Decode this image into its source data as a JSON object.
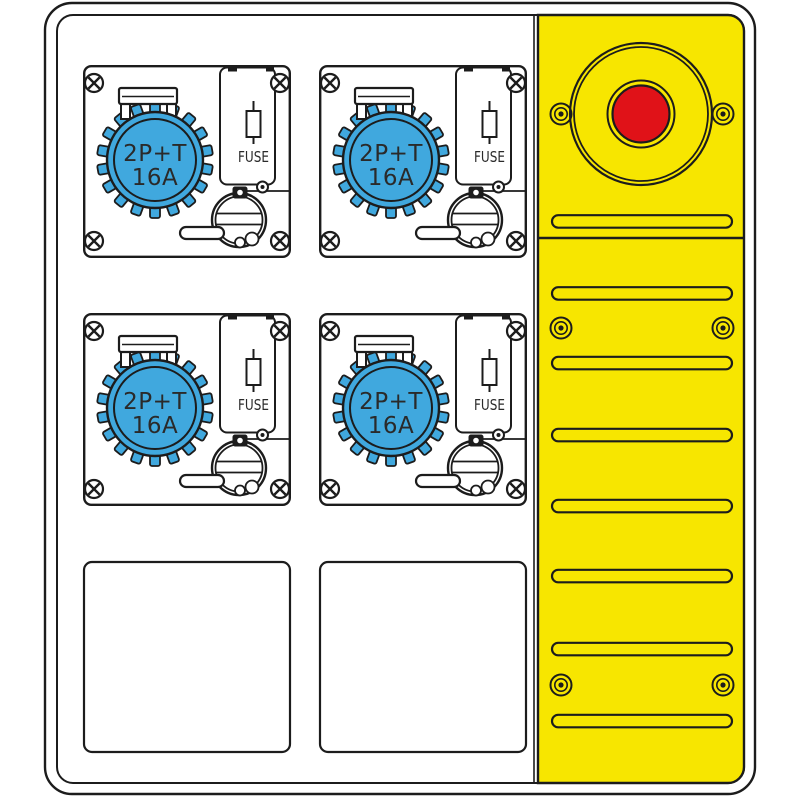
{
  "colors": {
    "socket_blue": "#40A8DE",
    "panel_yellow": "#F7E600",
    "estop_red": "#E01218",
    "outline": "#1C1C1C"
  },
  "modules": [
    {
      "rating_top": "2P+T",
      "rating_bottom": "16A",
      "fuse_label": "FUSE"
    },
    {
      "rating_top": "2P+T",
      "rating_bottom": "16A",
      "fuse_label": "FUSE"
    },
    {
      "rating_top": "2P+T",
      "rating_bottom": "16A",
      "fuse_label": "FUSE"
    },
    {
      "rating_top": "2P+T",
      "rating_bottom": "16A",
      "fuse_label": "FUSE"
    }
  ]
}
